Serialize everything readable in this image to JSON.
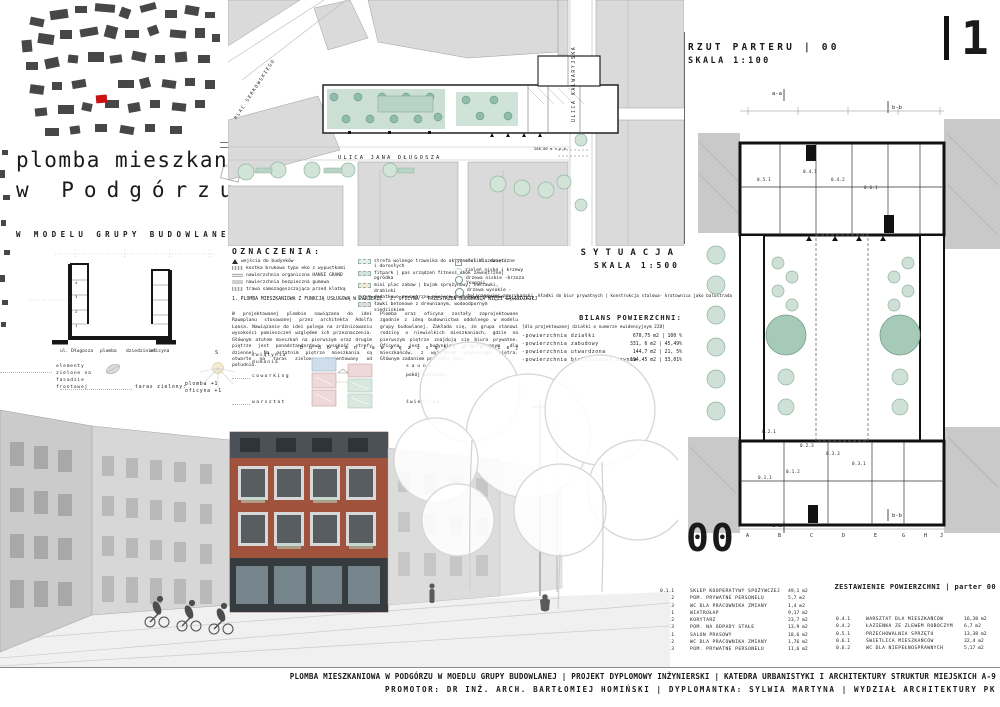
{
  "page": {
    "number": "1"
  },
  "title_block": {
    "line1": "plomba mieszkaniowa",
    "line2": "w Podgórzu",
    "subtitle": "W MODELU GRUPY BUDOWLANEJ"
  },
  "site_plan": {
    "caption": "SYTUACJA",
    "scale": "SKALA 1:500",
    "streets": {
      "plac_serkowskiego": "PLAC SERKOWSKIEGO",
      "ulica_kalwaryjska": "ULICA KALWARYJSKA",
      "ulica_jana_dlugosza": "ULICA JANA DŁUGOSZA"
    },
    "elevation_note": "206,00 m n.p.m.",
    "bridge_note": "kładki do biur prywatnych | konstrukcja stalowa- kratownica jako balustrada"
  },
  "legend": {
    "title": "OZNACZENIA:",
    "col1": [
      "wejścia do budynków",
      "kostka brukowa typu eko z wypustkami",
      "nawierzchnia organiczna HANSE GRAND",
      "nawierzchnia bezpieczna gumowa",
      "trawa samozagęszczająca przed klatką"
    ],
    "col2": [
      "strefa wolnego trawnika do aktywności dla dzieci i dorosłych",
      "fitpark | pas urządzeń fitness obok zewnętrznej ogródka",
      "mini plac zabaw | bujak sprężynowy, huśtawki, drabinki",
      "dodatkowe zewnętrzne miejsca postojowe rowerowe",
      "ławki betonowe z drewnianym, wodoodpornym siedziskiem"
    ],
    "col3": [
      "stoliki zewnętrzne",
      "zieleń niska i krzewy",
      "drzewa niskie -brzoza Youngii",
      "drzewa wysokie -tulipanowiec amerykański"
    ],
    "caption1": "1. PLOMBA MIESZKANIOWA Z FUNKCJĄ USŁUGOWĄ W PARTERZE",
    "caption2": "2. OFICYNA - PRZESTRZEŃ BUDOWANIA WIĘZI SĄSIEDZKIEJ"
  },
  "paragraphs": {
    "left": "W projektowanej plombie nawiązano do idei Raumplanu stosowanej przez architekta Adolfa Loosa. Nawiązanie do idei polega na zróżnicowaniu wysokości pomieszczeń względem ich przeznaczenia. Głównym atutem mieszkań na pierwszym oraz drugim piętrze jest ponadstandardowa wysokość strefy dziennej. Na ostatnim piętrze mieszkania są otwarte na taras zielony, zorientowany od południa.",
    "right": "Plomba oraz oficyna zostały zaprojektowane zgodnie z ideą budownictwa oddolnego w modelu grupy budowlanej. Zakłada się, że grupa stanowi rodziny o niewielkich mieszkaniach, gdzie na pierwszym piętrze znajdują się biura prywatne. Oficyna jest budynkiem przeznaczonym dla mieszkańców, z wyjątkiem pierwszego piętra. Głównym zadaniem projektu jest",
    "right_last": "b u d o w a n i a   w i ę z i   s ą s i e d z k i e j"
  },
  "bilans": {
    "title": "BILANS POWIERZCHNI:",
    "note": "[dla projektowanej działki o numerze ewidencyjnym 228]",
    "rows": [
      {
        "label": "-powierzchnia działki",
        "value": "670,75 m2 | 100 %"
      },
      {
        "label": "-powierzchnia zabudowy",
        "value": "331, 6 m2 | 45,49%"
      },
      {
        "label": "-powierzchnia utwardzona",
        "value": "144,7 m2 | 21, 5%"
      },
      {
        "label": "-powierzchnia biologicznie czynna",
        "value": "194,45 m2 | 33,01%"
      }
    ]
  },
  "section_diagram": {
    "labels": [
      "ul. Długosza",
      "plomba",
      "dziedziniec",
      "oficyna"
    ],
    "floors": [
      "4",
      "3",
      "2",
      "1"
    ],
    "green_note": "elementy zielone na fasadzie frontowej",
    "taras_label": "taras zielony:",
    "taras_value1": "plomba +1",
    "taras_value2": "oficyna +1",
    "sun_label": "S"
  },
  "axon": {
    "left": [
      "świątynia dumania",
      "coworking",
      "warsztat"
    ],
    "right": [
      "s a u n a",
      "pokój gościnny",
      "świetlica"
    ]
  },
  "plan": {
    "title": "RZUT PARTERU | 00",
    "scale": "SKALA 1:100",
    "big_label": "00",
    "schedule_title": "ZESTAWIENIE POWIERZCHNI | parter 00",
    "grid_letters": [
      "A",
      "B",
      "C",
      "D",
      "E",
      "G",
      "H",
      "J"
    ],
    "markers": {
      "aa": "a-a",
      "bb": "b-b"
    },
    "room_labels": [
      "0.5.1",
      "0.4.1",
      "0.4.2",
      "0.6.1",
      "0.2.1",
      "0.2.3",
      "0.3.3",
      "0.3.1",
      "0.1.2",
      "0.1.1"
    ]
  },
  "schedule_left": {
    "rows": [
      {
        "no": "0.1.1",
        "name": "SKLEP KOOPERATYWY SPOŻYWCZEJ",
        "area": "49,1 m2"
      },
      {
        "no": "0.1.2",
        "name": "POM. PRYWATNE PERSONELU",
        "area": "5,7 m2"
      },
      {
        "no": "0.1.3",
        "name": "WC DLA PRACOWNIKA ZMIANY",
        "area": "1,4 m2"
      },
      {
        "no": "0.2.1",
        "name": "WIATROŁAP",
        "area": "9,17 m2"
      },
      {
        "no": "0.2.2",
        "name": "KORYTARZ",
        "area": "23,7 m2"
      },
      {
        "no": "0.2.3",
        "name": "POM. NA ODPADY STAŁE",
        "area": "13,9 m2"
      },
      {
        "no": "0.3.1",
        "name": "SALON PRASOWY",
        "area": "18,6 m2"
      },
      {
        "no": "0.3.2",
        "name": "WC DLA PRACOWNIKA ZMIANY",
        "area": "1,76 m2"
      },
      {
        "no": "0.3.3",
        "name": "POM. PRYWATNE PERSONELU",
        "area": "11,6 m2"
      }
    ]
  },
  "schedule_right": {
    "rows": [
      {
        "no": "0.4.1",
        "name": "WARSZTAT DLA MIESZKAŃCÓW",
        "area": "16,38 m2"
      },
      {
        "no": "0.4.2",
        "name": "ŁAZIENKA ZE ZLEWEM ROBOCZYM",
        "area": "6,7 m2"
      },
      {
        "no": "0.5.1",
        "name": "PRZECHOWALNIA SPRZĘTU",
        "area": "13,38 m2"
      },
      {
        "no": "0.6.1",
        "name": "ŚWIETLICA MIESZKAŃCÓW",
        "area": "32,4 m2"
      },
      {
        "no": "0.6.2",
        "name": "WC DLA NIEPEŁNOSPRAWNYCH",
        "area": "5,17 m2"
      }
    ]
  },
  "footer": {
    "line1": "PLOMBA MIESZKANIOWA W PODGÓRZU W MOEDLU GRUPY BUDOWLANEJ  | PROJEKT  DYPLOMOWY INŻYNIERSKI | KATEDRA  URBANISTYKI  I ARCHITEKTURY STRUKTUR MIEJSKICH A-9",
    "line2": "PROMOTOR: DR INŻ. ARCH. BARTŁOMIEJ HOMIŃSKI | DYPLOMANTKA: SYLWIA MARTYNA |  WYDZIAŁ ARCHITEKTURY PK"
  },
  "colors": {
    "accent_red": "#cc1111",
    "tree_green": "#a5cab8",
    "brick": "#a0523c",
    "attic_gray": "#4b5156",
    "ink": "#1a1a1a"
  }
}
